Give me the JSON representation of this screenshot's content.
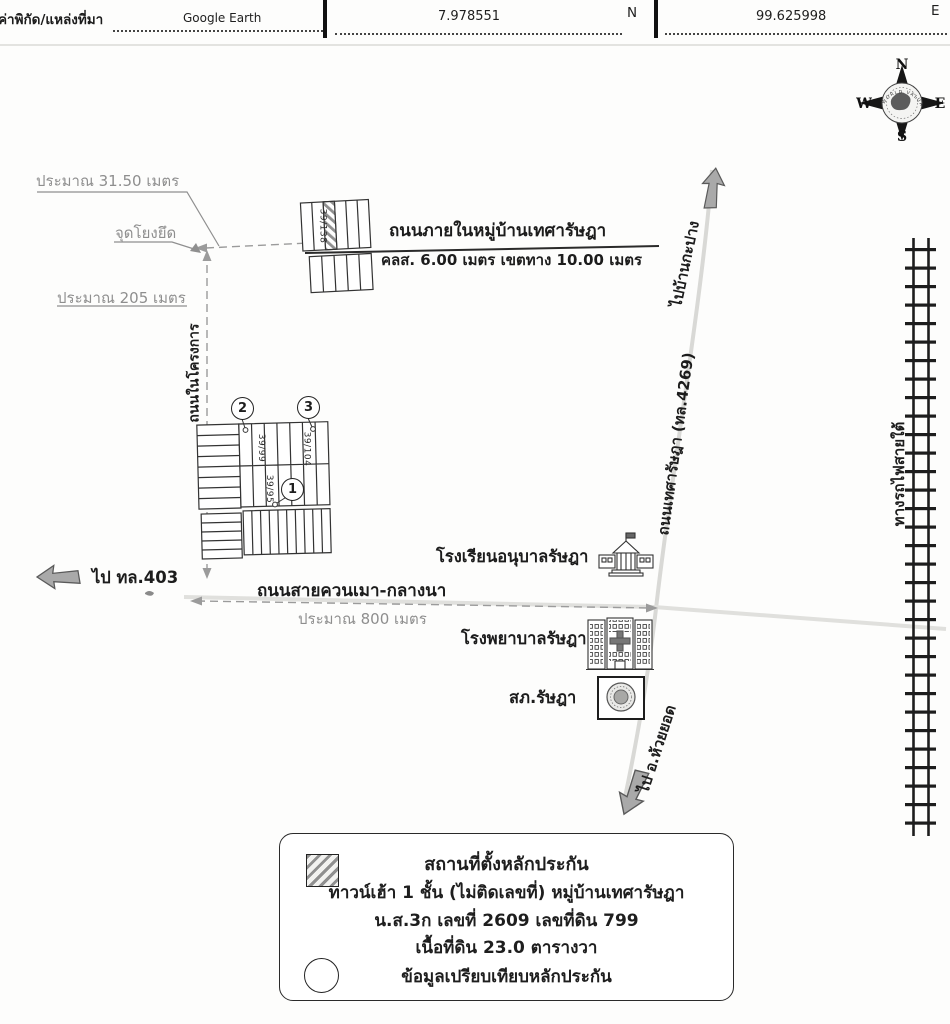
{
  "header": {
    "field_label": "ค่าพิกัด/แหล่งที่มา",
    "source": "Google Earth",
    "latitude": "7.978551",
    "lat_dir": "N",
    "longitude": "99.625998",
    "lon_dir": "E"
  },
  "compass": {
    "n": "N",
    "s": "S",
    "e": "E",
    "w": "W",
    "brand": "WORLD VALUATION"
  },
  "map": {
    "dim_width": "ประมาณ 31.50 เมตร",
    "anchor_point": "จุดโยงยึด",
    "dim_height": "ประมาณ 205 เมตร",
    "project_road": "ถนนในโครงการ",
    "village_road_name": "ถนนภายในหมู่บ้านเทศารัษฎา",
    "village_road_spec": "คลส. 6.00 เมตร เขตทาง 10.00 เมตร",
    "plot_top": "39/138",
    "plot_2": "39/99",
    "plot_3": "39/104",
    "plot_1": "39/95",
    "markers": {
      "m1": "1",
      "m2": "2",
      "m3": "3"
    },
    "to_kapang": "ไปบ้านกะปาง",
    "thesa_road": "ถนนเทศารัษฎา (ทล.4269)",
    "railway": "ทางรถไฟสายใต้",
    "to_403": "ไป ทล.403",
    "kuan_mao_road": "ถนนสายควนเมา-กลางนา",
    "dim_800": "ประมาณ 800 เมตร",
    "school": "โรงเรียนอนุบาลรัษฎา",
    "hospital": "โรงพยาบาลรัษฎา",
    "police": "สภ.รัษฎา",
    "to_huai_yot": "ไป อ.ห้วยยอด"
  },
  "legend": {
    "line1": "สถานที่ตั้งหลักประกัน",
    "line2": "ทาวน์เฮ้า 1 ชั้น (ไม่ติดเลขที่)  หมู่บ้านเทศารัษฎา",
    "line3": "น.ส.3ก เลขที่ 2609 เลขที่ดิน 799",
    "line4": "เนื้อที่ดิน 23.0 ตารางวา",
    "line5": "ข้อมูลเปรียบเทียบหลักประกัน"
  },
  "colors": {
    "ink": "#1c1c1c",
    "gray_text": "#8e8e8e",
    "faint_road": "#d9d9d6",
    "arrow_fill": "#a9a9a9",
    "hatch": "#8f8f8f"
  }
}
